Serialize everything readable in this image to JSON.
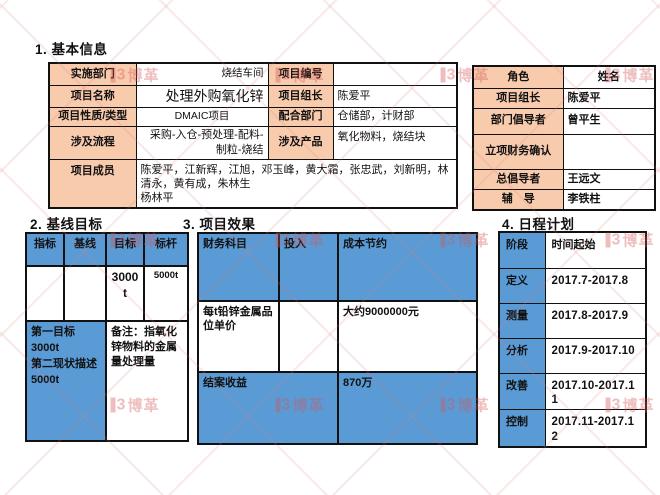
{
  "colors": {
    "peach": "#F8CBAD",
    "blue": "#5B9BD5",
    "border": "#111111",
    "watermark": "#D35555"
  },
  "watermark": {
    "logo_text": "博革",
    "cols": [
      -30,
      135,
      300,
      465,
      630
    ],
    "rows": [
      75,
      240,
      405
    ]
  },
  "basic_info": {
    "heading": "1. 基本信息",
    "impl_dept_label": "实施部门",
    "impl_dept": "烧结车间",
    "project_no_label": "项目编号",
    "project_no": "",
    "project_name_label": "项目名称",
    "project_name": "处理外购氧化锌",
    "leader_label": "项目组长",
    "leader": "陈爱平",
    "type_label": "项目性质/类型",
    "type": "DMAIC项目",
    "coop_dept_label": "配合部门",
    "coop_dept": "仓储部，计财部",
    "process_label": "涉及流程",
    "process": "采购-入仓-预处理-配料-制粒-烧结",
    "product_label": "涉及产品",
    "product": "氧化物料，烧结块",
    "members_label": "项目成员",
    "members": "陈爱平，江新辉，江旭，邓玉峰，黄大霜，张忠武，刘新明，林清永，黄有成，朱林生\n杨林平"
  },
  "roles": {
    "header_role": "角色",
    "header_name": "姓名",
    "rows": [
      {
        "role": "项目组长",
        "name": "陈爱平"
      },
      {
        "role": "部门倡导者",
        "name": "曾平生"
      },
      {
        "role": "立项财务确认",
        "name": ""
      },
      {
        "role": "总倡导者",
        "name": "王远文"
      },
      {
        "role": "辅　导",
        "name": "李铁柱"
      }
    ]
  },
  "baseline": {
    "heading": "2. 基线目标",
    "headers": [
      "指标",
      "基线",
      "目标",
      "标杆"
    ],
    "target_value": "3000t",
    "benchmark_value": "5000t",
    "goal_text": "第一目标\n3000t\n第二现状描述\n5000t",
    "note_text": "备注：指氧化锌物料的金属量处理量"
  },
  "effects": {
    "heading": "3. 项目效果",
    "headers": [
      "财务科目",
      "投入",
      "成本节约"
    ],
    "item_name": "每t铅锌金属品位单价",
    "item_invest": "",
    "item_saving": "大约9000000元",
    "closing_label": "结案收益",
    "closing_value": "870万"
  },
  "schedule": {
    "heading": "4. 日程计划",
    "header_phase": "阶段",
    "header_time": "时间起始",
    "rows": [
      {
        "phase": "定义",
        "time": "2017.7-2017.8"
      },
      {
        "phase": "测量",
        "time": "2017.8-2017.9"
      },
      {
        "phase": "分析",
        "time": "2017.9-2017.10"
      },
      {
        "phase": "改善",
        "time": "2017.10-2017.11"
      },
      {
        "phase": "控制",
        "time": "2017.11-2017.12"
      }
    ]
  }
}
